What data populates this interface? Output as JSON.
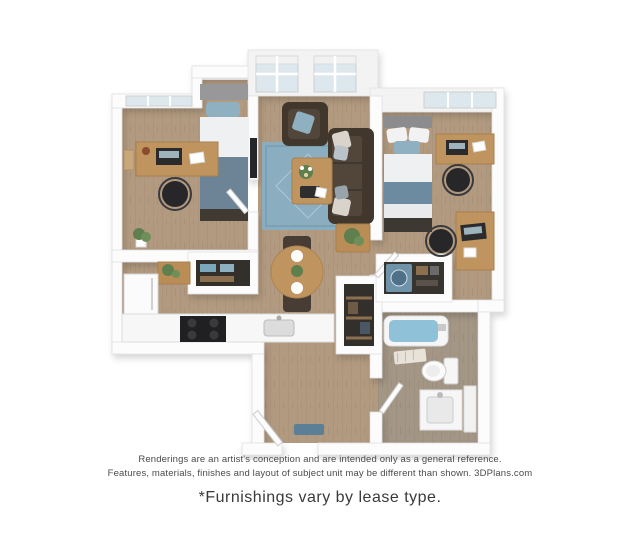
{
  "disclaimer": {
    "line1": "Renderings are an artist's conception and are intended only as a general reference.",
    "line2": "Features, materials, finishes and layout of subject unit may be different than shown. 3DPlans.com"
  },
  "note": "*Furnishings vary by lease type.",
  "floorplan": {
    "type": "3d-rendered-floor-plan",
    "furniture_icons": [
      "bed",
      "desk",
      "office-chair",
      "sofa",
      "armchair",
      "coffee-table",
      "side-table",
      "dining-table",
      "dining-chair",
      "rug",
      "tv",
      "refrigerator",
      "stove",
      "kitchen-sink",
      "pantry-closet",
      "washer",
      "closet-shelves",
      "bathtub",
      "toilet",
      "vanity-sink",
      "door",
      "door-mat",
      "window",
      "plant"
    ],
    "colors": {
      "wall": "#fcfcfc",
      "wall_edge": "#e0e0e0",
      "wall_face": "#f3f3f3",
      "floor_wood": "#b29a80",
      "floor_bath": "#a49685",
      "rug": "#8aadc0",
      "rug_border": "#6f95a9",
      "sofa": "#41372d",
      "sofa_cushion": "#52453a",
      "accent_blue": "#8fb0c0",
      "bed_blue": "#6c8496",
      "bed_blue_2": "#6c8ba1",
      "linen_white": "#eef0f1",
      "wood_furniture": "#c0945e",
      "wood_dark": "#b98d55",
      "tub_water": "#8fc1d8",
      "washer_blue": "#6f93a9",
      "doormat": "#5b7f96",
      "appliance_dark": "#202022",
      "closet_dark": "#332f2b",
      "plant_green": "#5f7f4f",
      "window_pane": "#dde8ee",
      "text_muted": "#4a4a4a",
      "text_note": "#3a3a3a"
    }
  }
}
